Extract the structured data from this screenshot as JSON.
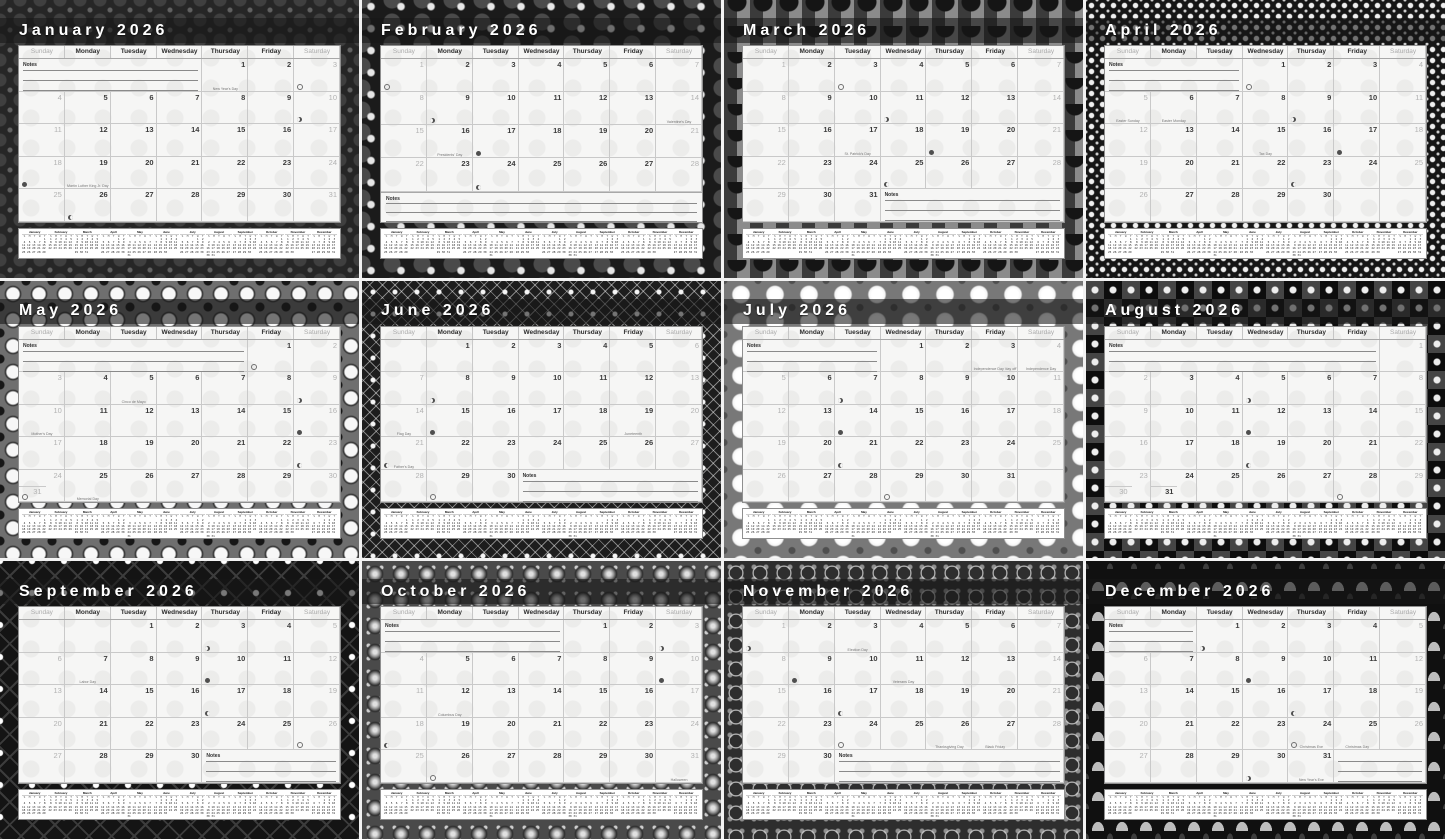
{
  "year": "2026",
  "weekday_headers": [
    "Sunday",
    "Monday",
    "Tuesday",
    "Wednesday",
    "Thursday",
    "Friday",
    "Saturday"
  ],
  "weekday_initials": [
    "S",
    "M",
    "T",
    "W",
    "T",
    "F",
    "S"
  ],
  "notes_label": "Notes",
  "moon_phases_legend": {
    "full": "full-moon",
    "new": "new-moon",
    "first": "first-quarter",
    "last": "last-quarter"
  },
  "colors": {
    "sheet": "#f6f6f5",
    "grid_line": "#c9c9c9",
    "title_text": "#ffffff",
    "weekend_text": "#b2b2b2",
    "weekday_text": "#3c3c3c"
  },
  "months": [
    {
      "name": "January",
      "title": "January 2026",
      "start_dow": 4,
      "days": 31,
      "notes": "first",
      "holidays": [
        {
          "day": 1,
          "label": "New Year's Day"
        },
        {
          "day": 19,
          "label": "Martin Luther King Jr. Day"
        }
      ],
      "moons": [
        {
          "day": 3,
          "phase": "full"
        },
        {
          "day": 10,
          "phase": "last"
        },
        {
          "day": 18,
          "phase": "new"
        },
        {
          "day": 26,
          "phase": "first"
        }
      ]
    },
    {
      "name": "February",
      "title": "February 2026",
      "start_dow": 0,
      "days": 28,
      "notes": "bottom",
      "holidays": [
        {
          "day": 14,
          "label": "Valentine's Day"
        },
        {
          "day": 16,
          "label": "Presidents' Day"
        }
      ],
      "moons": [
        {
          "day": 1,
          "phase": "full"
        },
        {
          "day": 9,
          "phase": "last"
        },
        {
          "day": 17,
          "phase": "new"
        },
        {
          "day": 24,
          "phase": "first"
        }
      ]
    },
    {
      "name": "March",
      "title": "March 2026",
      "start_dow": 0,
      "days": 31,
      "notes": "last",
      "holidays": [
        {
          "day": 17,
          "label": "St. Patrick's Day"
        }
      ],
      "moons": [
        {
          "day": 3,
          "phase": "full"
        },
        {
          "day": 11,
          "phase": "last"
        },
        {
          "day": 19,
          "phase": "new"
        },
        {
          "day": 25,
          "phase": "first"
        }
      ]
    },
    {
      "name": "April",
      "title": "April 2026",
      "start_dow": 3,
      "days": 30,
      "notes": "first",
      "holidays": [
        {
          "day": 5,
          "label": "Easter Sunday"
        },
        {
          "day": 6,
          "label": "Easter Monday"
        },
        {
          "day": 15,
          "label": "Tax Day"
        }
      ],
      "moons": [
        {
          "day": 1,
          "phase": "full"
        },
        {
          "day": 9,
          "phase": "last"
        },
        {
          "day": 17,
          "phase": "new"
        },
        {
          "day": 23,
          "phase": "first"
        }
      ]
    },
    {
      "name": "May",
      "title": "May 2026",
      "start_dow": 5,
      "days": 31,
      "notes": "first",
      "holidays": [
        {
          "day": 5,
          "label": "Cinco de Mayo"
        },
        {
          "day": 10,
          "label": "Mother's Day"
        },
        {
          "day": 25,
          "label": "Memorial Day"
        }
      ],
      "moons": [
        {
          "day": 1,
          "phase": "full"
        },
        {
          "day": 9,
          "phase": "last"
        },
        {
          "day": 16,
          "phase": "new"
        },
        {
          "day": 23,
          "phase": "first"
        },
        {
          "day": 31,
          "phase": "full"
        }
      ]
    },
    {
      "name": "June",
      "title": "June 2026",
      "start_dow": 1,
      "days": 30,
      "notes": "last",
      "holidays": [
        {
          "day": 14,
          "label": "Flag Day"
        },
        {
          "day": 19,
          "label": "Juneteenth"
        },
        {
          "day": 21,
          "label": "Father's Day"
        }
      ],
      "moons": [
        {
          "day": 8,
          "phase": "last"
        },
        {
          "day": 15,
          "phase": "new"
        },
        {
          "day": 21,
          "phase": "first"
        },
        {
          "day": 29,
          "phase": "full"
        }
      ]
    },
    {
      "name": "July",
      "title": "July 2026",
      "start_dow": 3,
      "days": 31,
      "notes": "first",
      "holidays": [
        {
          "day": 3,
          "label": "Independence Day 'day off'"
        },
        {
          "day": 4,
          "label": "Independence Day"
        }
      ],
      "moons": [
        {
          "day": 7,
          "phase": "last"
        },
        {
          "day": 14,
          "phase": "new"
        },
        {
          "day": 21,
          "phase": "first"
        },
        {
          "day": 29,
          "phase": "full"
        }
      ]
    },
    {
      "name": "August",
      "title": "August 2026",
      "start_dow": 6,
      "days": 31,
      "notes": "first",
      "holidays": [],
      "moons": [
        {
          "day": 5,
          "phase": "last"
        },
        {
          "day": 12,
          "phase": "new"
        },
        {
          "day": 19,
          "phase": "first"
        },
        {
          "day": 28,
          "phase": "full"
        }
      ]
    },
    {
      "name": "September",
      "title": "September 2026",
      "start_dow": 2,
      "days": 30,
      "notes": "last",
      "holidays": [
        {
          "day": 7,
          "label": "Labor Day"
        }
      ],
      "moons": [
        {
          "day": 3,
          "phase": "last"
        },
        {
          "day": 10,
          "phase": "new"
        },
        {
          "day": 17,
          "phase": "first"
        },
        {
          "day": 26,
          "phase": "full"
        }
      ]
    },
    {
      "name": "October",
      "title": "October 2026",
      "start_dow": 4,
      "days": 31,
      "notes": "first",
      "holidays": [
        {
          "day": 12,
          "label": "Columbus Day"
        },
        {
          "day": 31,
          "label": "Halloween"
        }
      ],
      "moons": [
        {
          "day": 3,
          "phase": "last"
        },
        {
          "day": 10,
          "phase": "new"
        },
        {
          "day": 18,
          "phase": "first"
        },
        {
          "day": 26,
          "phase": "full"
        }
      ]
    },
    {
      "name": "November",
      "title": "November 2026",
      "start_dow": 0,
      "days": 30,
      "notes": "last",
      "holidays": [
        {
          "day": 3,
          "label": "Election Day"
        },
        {
          "day": 11,
          "label": "Veterans Day"
        },
        {
          "day": 26,
          "label": "Thanksgiving Day"
        },
        {
          "day": 27,
          "label": "Black Friday"
        }
      ],
      "moons": [
        {
          "day": 1,
          "phase": "last"
        },
        {
          "day": 9,
          "phase": "new"
        },
        {
          "day": 17,
          "phase": "first"
        },
        {
          "day": 24,
          "phase": "full"
        }
      ]
    },
    {
      "name": "December",
      "title": "December 2026",
      "start_dow": 2,
      "days": 31,
      "notes": "first",
      "notes_last_lines": true,
      "holidays": [
        {
          "day": 24,
          "label": "Christmas Eve"
        },
        {
          "day": 25,
          "label": "Christmas Day"
        },
        {
          "day": 31,
          "label": "New Year's Eve"
        }
      ],
      "moons": [
        {
          "day": 1,
          "phase": "last"
        },
        {
          "day": 9,
          "phase": "new"
        },
        {
          "day": 17,
          "phase": "first"
        },
        {
          "day": 24,
          "phase": "full"
        },
        {
          "day": 30,
          "phase": "last"
        }
      ]
    }
  ]
}
